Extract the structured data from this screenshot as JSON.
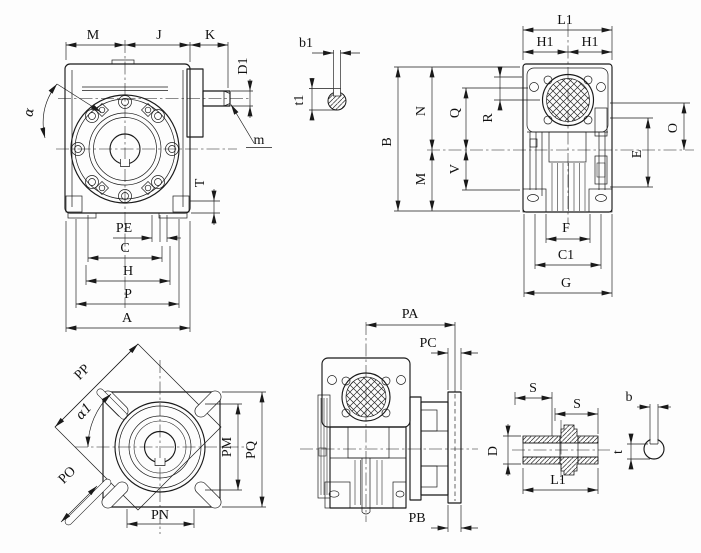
{
  "drawing": {
    "kind": "worm-gearbox-dimension-drawing",
    "views": {
      "front": {
        "name": "front-view",
        "dims": {
          "M": "M",
          "J": "J",
          "K": "K",
          "D1": "D1",
          "m": "m",
          "alpha": "α",
          "T": "T",
          "PE": "PE",
          "C": "C",
          "H": "H",
          "P": "P",
          "A": "A"
        }
      },
      "input_key": {
        "name": "input-shaft-key-section",
        "dims": {
          "b1": "b1",
          "t1": "t1"
        }
      },
      "side": {
        "name": "input-end-view",
        "dims": {
          "L1": "L1",
          "H1a": "H1",
          "H1b": "H1",
          "B": "B",
          "N": "N",
          "M": "M",
          "Q": "Q",
          "V": "V",
          "R": "R",
          "O": "O",
          "E": "E",
          "F": "F",
          "C1": "C1",
          "G": "G"
        }
      },
      "flange": {
        "name": "output-flange-view",
        "dims": {
          "PP": "PP",
          "alpha1": "α1",
          "PO": "PO",
          "PM": "PM",
          "PQ": "PQ",
          "PN": "PN"
        }
      },
      "output_side": {
        "name": "output-flange-side-view",
        "dims": {
          "PA": "PA",
          "PC": "PC",
          "PB": "PB"
        }
      },
      "hollow_shaft": {
        "name": "hollow-output-shaft-section",
        "dims": {
          "S1": "S",
          "S2": "S",
          "D": "D",
          "L1": "L1"
        }
      },
      "output_key": {
        "name": "output-shaft-key-section",
        "dims": {
          "b": "b",
          "t": "t"
        }
      }
    }
  }
}
